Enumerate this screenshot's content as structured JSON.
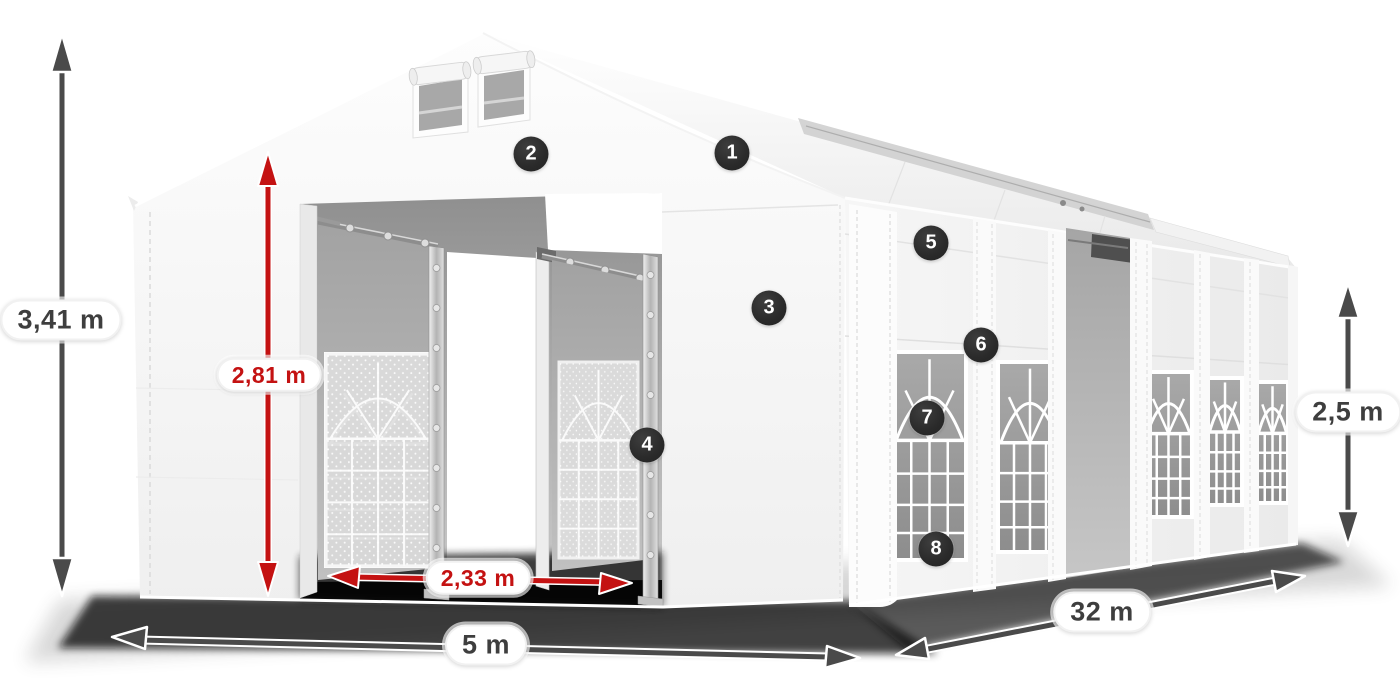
{
  "dimensions": {
    "total_height": {
      "label": "3,41 m"
    },
    "entrance_height": {
      "label": "2,81 m"
    },
    "entrance_width": {
      "label": "2,33 m"
    },
    "front_width": {
      "label": "5 m"
    },
    "side_length": {
      "label": "32 m"
    },
    "side_height": {
      "label": "2,5 m"
    }
  },
  "markers": [
    {
      "number": "1"
    },
    {
      "number": "2"
    },
    {
      "number": "3"
    },
    {
      "number": "4"
    },
    {
      "number": "5"
    },
    {
      "number": "6"
    },
    {
      "number": "7"
    },
    {
      "number": "8"
    }
  ],
  "colors": {
    "accent_red": "#c41212",
    "dimension_dark": "#4a4a4a",
    "marker_background": "#2a2a2a",
    "tent_white": "#f7f7f7",
    "interior_gray": "#b3b3b3",
    "window_glass_gray": "#9b9b9b"
  }
}
